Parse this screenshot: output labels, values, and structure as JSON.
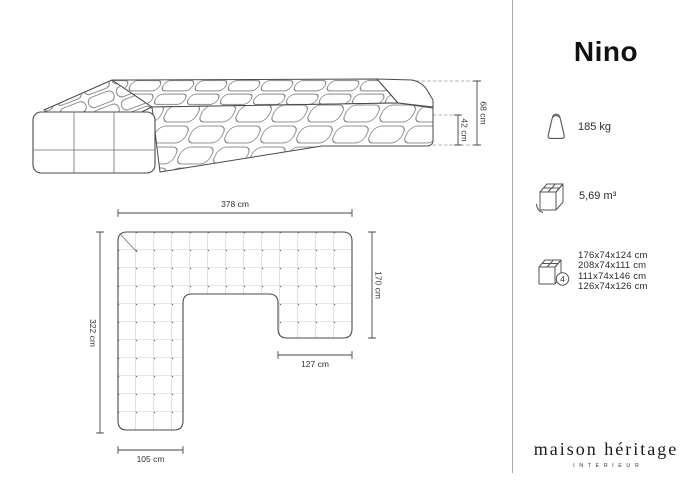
{
  "product": {
    "title": "Nino"
  },
  "diagrams": {
    "side_view": {
      "total_height": "68 cm",
      "seat_height": "42 cm"
    },
    "top_view": {
      "total_width": "378 cm",
      "left_depth": "322 cm",
      "right_depth": "170 cm",
      "right_chaise_width": "127 cm",
      "left_arm_width": "105 cm"
    }
  },
  "specs": {
    "weight": {
      "icon": "weight-icon",
      "label": "185 kg"
    },
    "volume": {
      "icon": "box-volume-icon",
      "label": "5,69 m³"
    },
    "packages": {
      "icon": "box-packages-icon",
      "count": "4",
      "dimensions": [
        "176x74x124 cm",
        "208x74x111 cm",
        "111x74x146 cm",
        "126x74x126 cm"
      ]
    }
  },
  "brand": {
    "name": "maison héritage",
    "subtitle": "INTERIEUR"
  },
  "colors": {
    "line": "#4a4a4a",
    "grid": "#8a8a8a",
    "text": "#2b2b2b",
    "divider": "#a8a8a8"
  }
}
